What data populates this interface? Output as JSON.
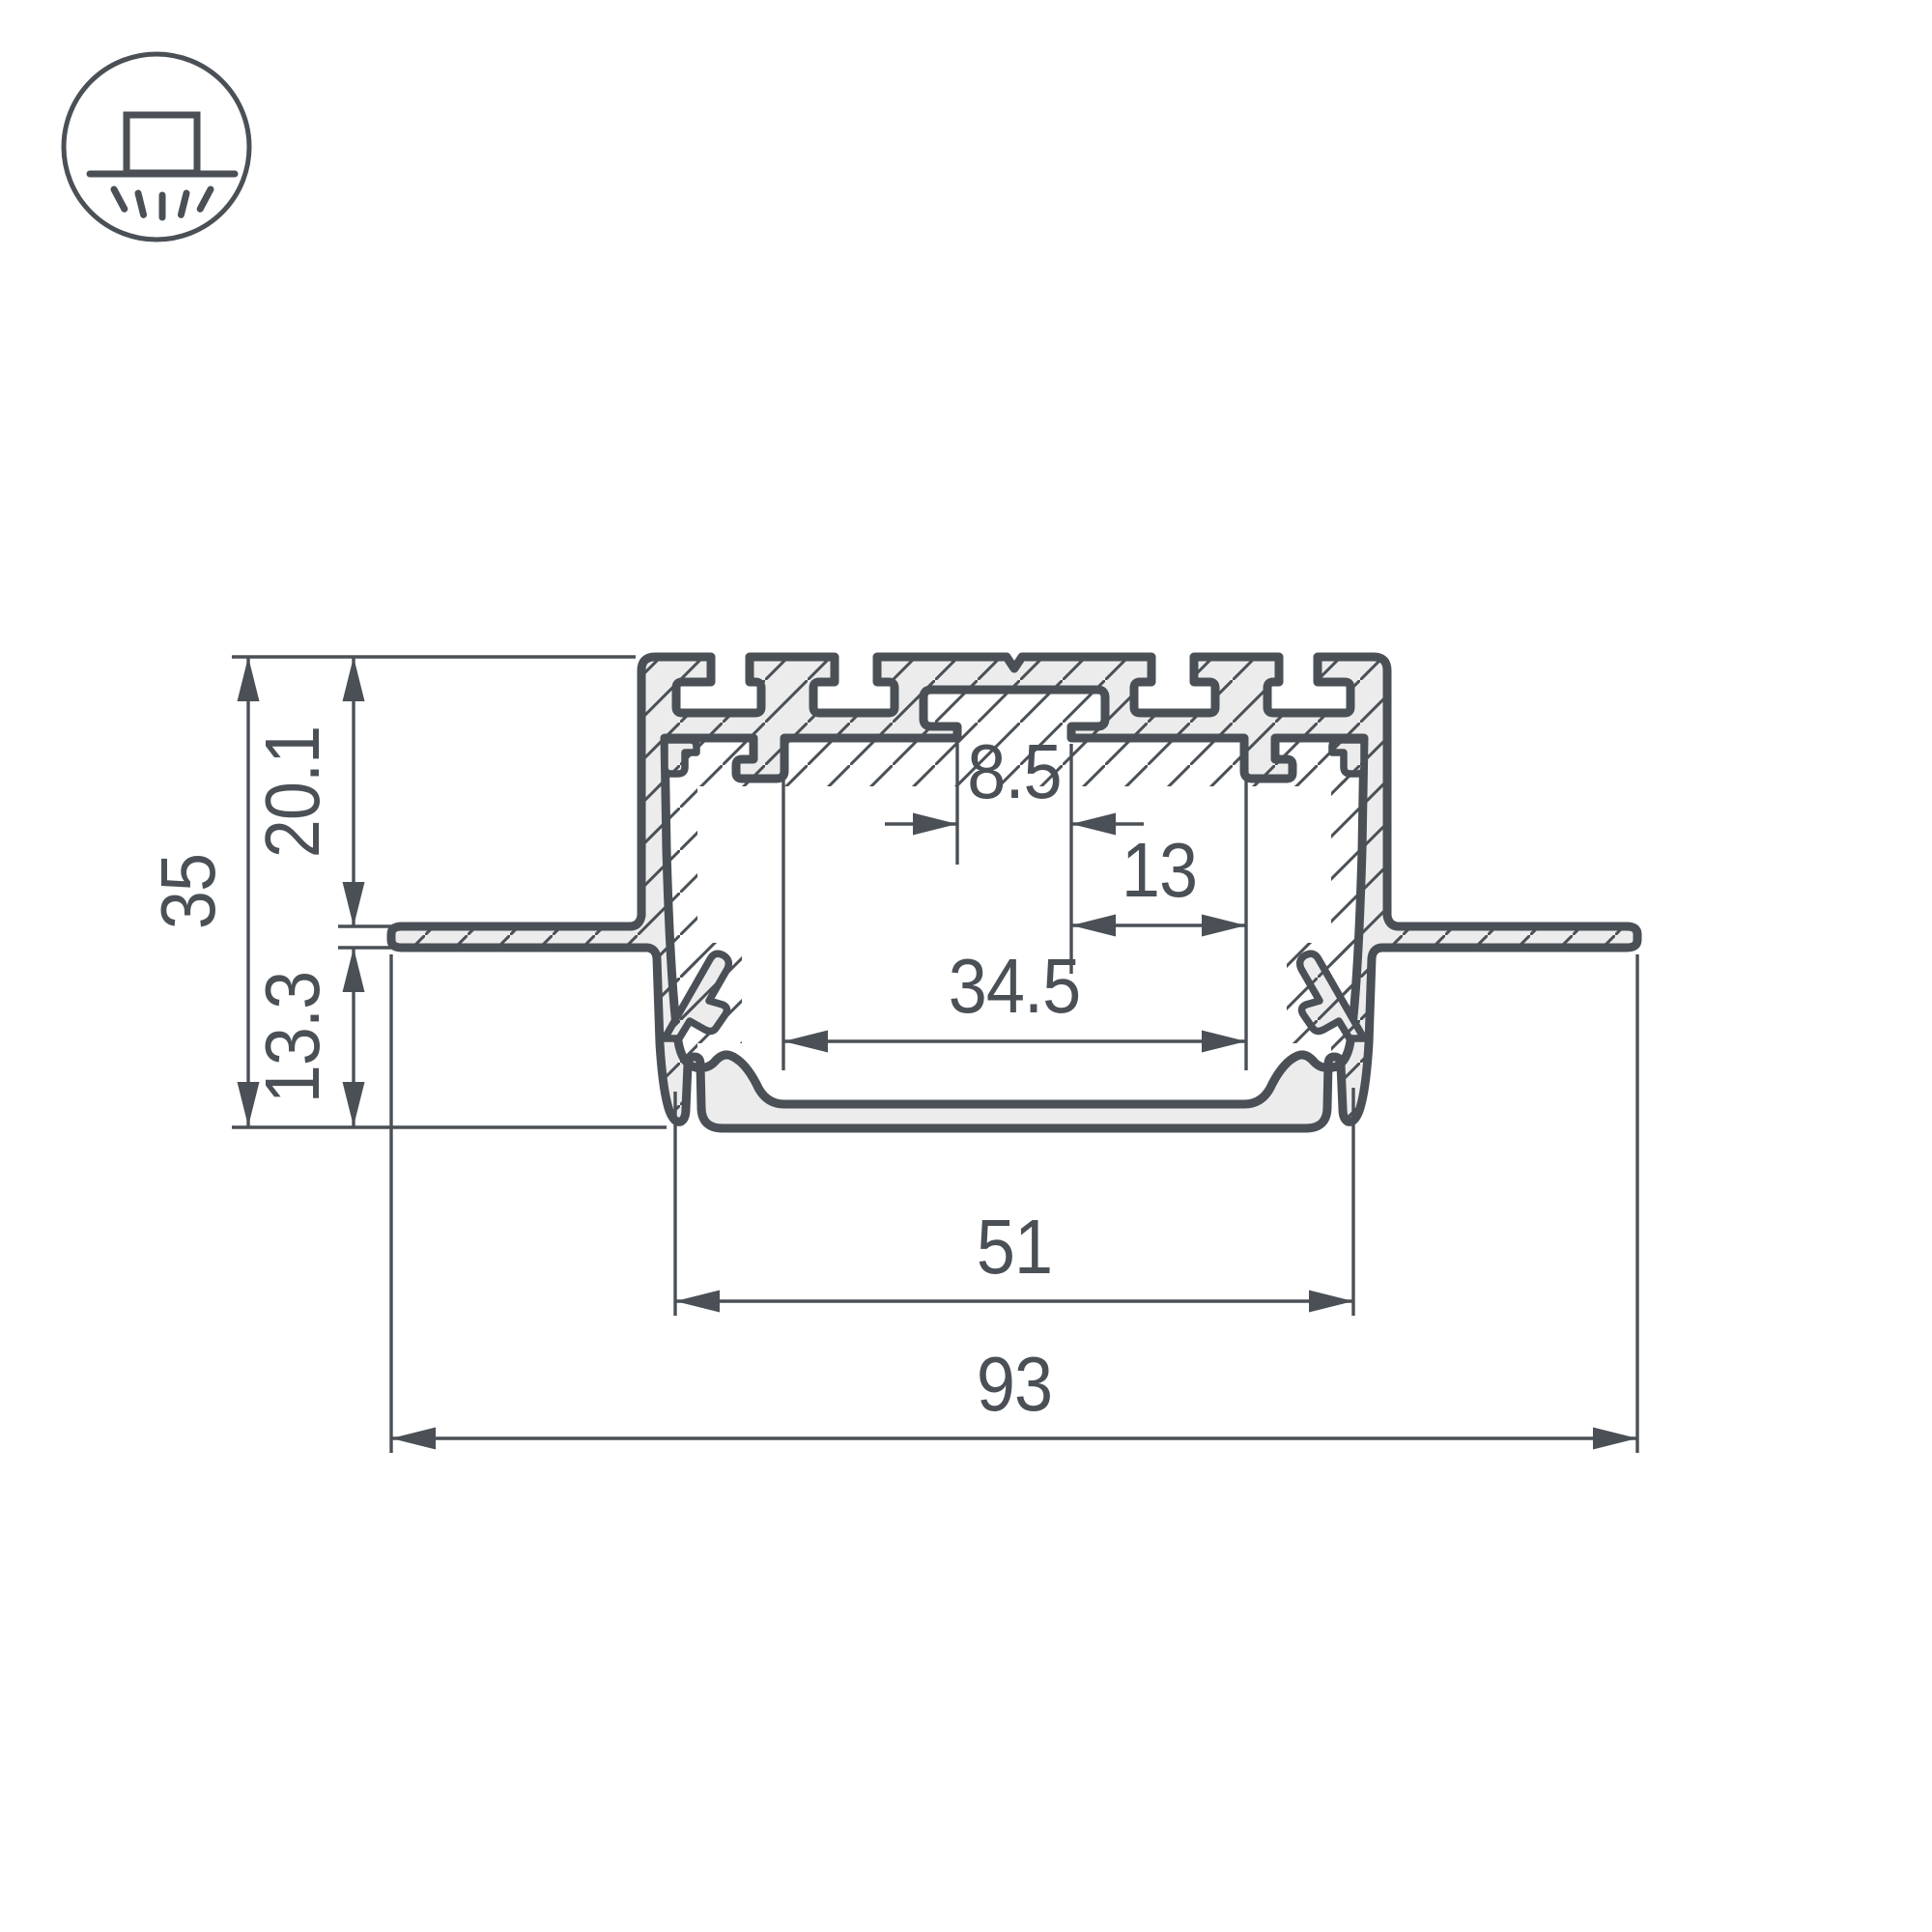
{
  "page": {
    "background": "#FFFFFF"
  },
  "icon": {
    "name": "recessed-downlight-icon",
    "meaning": "recessed mounting luminaire symbol"
  },
  "colors": {
    "line": "#4A5056",
    "metal_fill": "#ECECEC",
    "text": "#4A5056",
    "background": "#FFFFFF"
  },
  "drawing": {
    "title": "LED profile cross-section with dimensions",
    "units": "mm"
  },
  "dims": {
    "total_height": "35",
    "upper_height": "20.1",
    "lower_height": "13.3",
    "center_slot_width": "8.5",
    "slot_offset": "13",
    "inner_width": "34.5",
    "body_width": "51",
    "overall_width": "93"
  }
}
